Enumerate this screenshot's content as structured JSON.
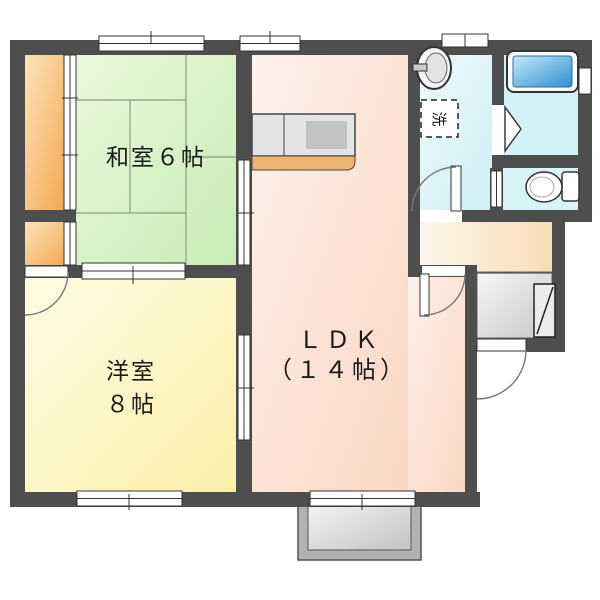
{
  "plan": {
    "type": "japanese-apartment-floor-plan",
    "rooms": {
      "washitsu": {
        "label": "和室６帖"
      },
      "youshitsu": {
        "label_line1": "洋室",
        "label_line2": "８帖"
      },
      "ldk": {
        "label_line1": "ＬＤＫ",
        "label_line2": "（１４帖）"
      },
      "laundry_space": {
        "label": "洗"
      }
    },
    "fixtures": [
      "kitchen-counter",
      "washbasin",
      "washing-machine-space",
      "bathtub",
      "toilet",
      "shoe-cabinet",
      "balcony",
      "entrance-genkan"
    ],
    "colors": {
      "wall": "#4e4e4e",
      "tatami_room_green": "#d9f2c8",
      "western_room_cream": "#fbf3c2",
      "ldk_pink": "#fbdfcf",
      "closet_orange": "#f5b164",
      "washroom_cyan": "#e4f7fa",
      "bathroom_cyan": "#d2f1f8",
      "toilet_cyan": "#d9f4f9",
      "hallway_peach": "#f9e4c4",
      "genkan_gray": "#d8d8d8",
      "balcony_gray": "#b2b2b2",
      "bathtub_blue": "#3f96d2",
      "counter_gray": "#e4e4e4",
      "counter_edge_orange": "#f0b472"
    }
  }
}
